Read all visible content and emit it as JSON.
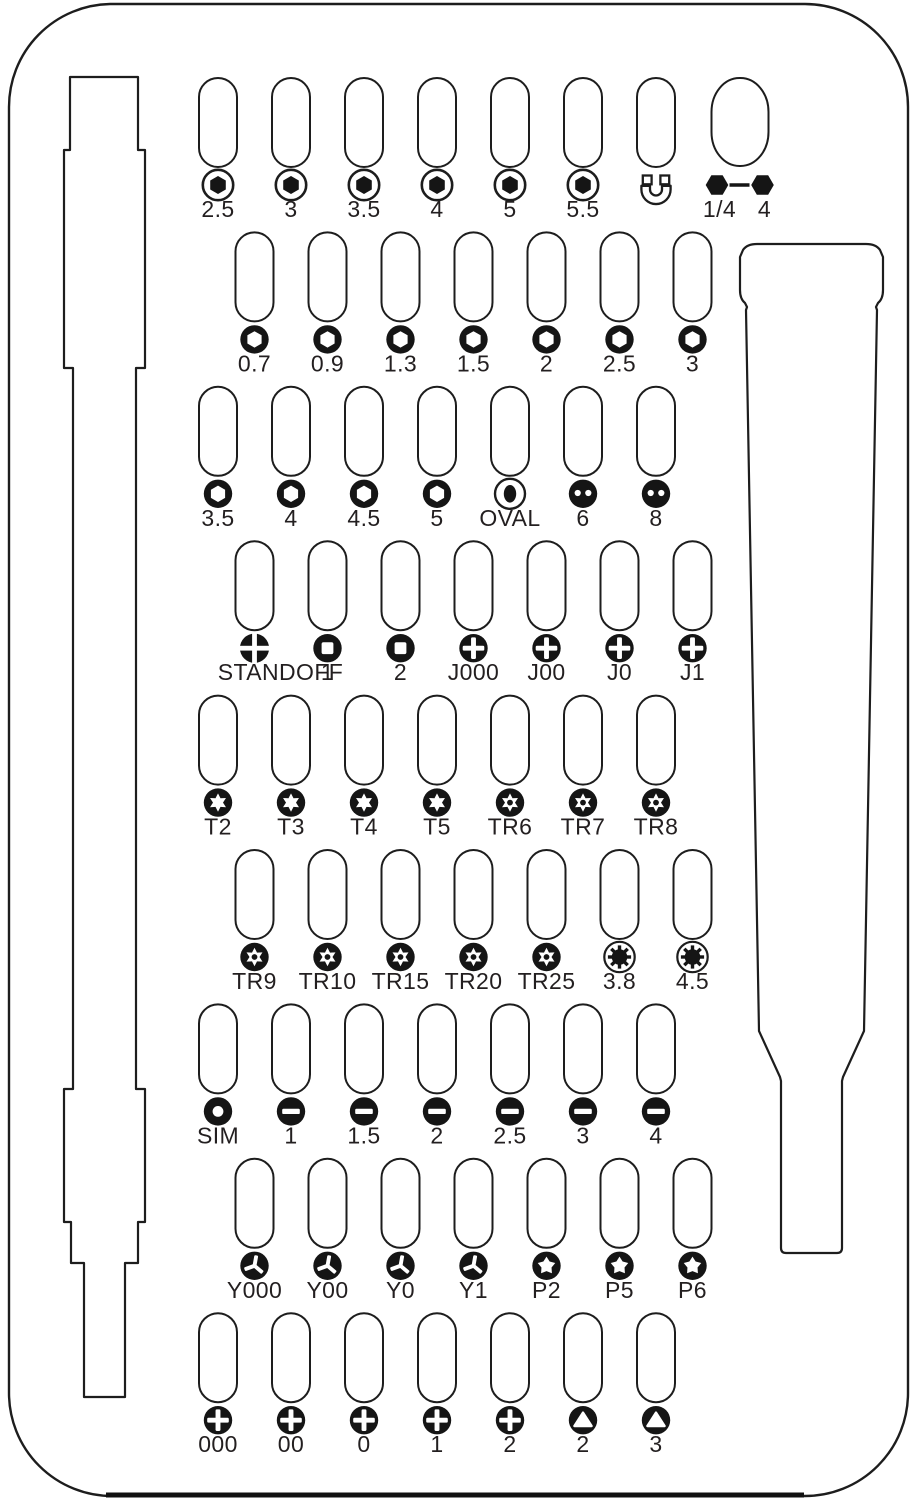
{
  "diagram": {
    "type": "screwdriver-bit-kit-tray",
    "colors": {
      "outline": "#1d1d1d",
      "bit": "#151515",
      "label": "#231f20",
      "background": "#ffffff"
    },
    "tools": [
      {
        "name": "extension-shaft-cutout"
      },
      {
        "name": "driver-handle-cutout"
      }
    ],
    "rows": [
      {
        "bits": [
          {
            "icon": "hex-socket",
            "label": "2.5"
          },
          {
            "icon": "hex-socket",
            "label": "3"
          },
          {
            "icon": "hex-socket",
            "label": "3.5"
          },
          {
            "icon": "hex-socket",
            "label": "4"
          },
          {
            "icon": "hex-socket",
            "label": "5"
          },
          {
            "icon": "hex-socket",
            "label": "5.5"
          },
          {
            "icon": "magnet",
            "label": ""
          },
          {
            "icon": "adapter",
            "label": "1/4",
            "label2": "4",
            "wide": true
          }
        ]
      },
      {
        "bits": [
          {
            "icon": "hex",
            "label": "0.7"
          },
          {
            "icon": "hex",
            "label": "0.9"
          },
          {
            "icon": "hex",
            "label": "1.3"
          },
          {
            "icon": "hex",
            "label": "1.5"
          },
          {
            "icon": "hex",
            "label": "2"
          },
          {
            "icon": "hex",
            "label": "2.5"
          },
          {
            "icon": "hex",
            "label": "3"
          }
        ]
      },
      {
        "bits": [
          {
            "icon": "hex",
            "label": "3.5"
          },
          {
            "icon": "hex",
            "label": "4"
          },
          {
            "icon": "hex",
            "label": "4.5"
          },
          {
            "icon": "hex",
            "label": "5"
          },
          {
            "icon": "oval",
            "label": "OVAL"
          },
          {
            "icon": "spanner",
            "label": "6"
          },
          {
            "icon": "spanner",
            "label": "8"
          }
        ]
      },
      {
        "bits": [
          {
            "icon": "standoff",
            "label": "STANDOFF"
          },
          {
            "icon": "square",
            "label": "1"
          },
          {
            "icon": "square",
            "label": "2"
          },
          {
            "icon": "phillips",
            "label": "J000"
          },
          {
            "icon": "phillips",
            "label": "J00"
          },
          {
            "icon": "phillips",
            "label": "J0"
          },
          {
            "icon": "phillips",
            "label": "J1"
          }
        ]
      },
      {
        "bits": [
          {
            "icon": "torx",
            "label": "T2"
          },
          {
            "icon": "torx",
            "label": "T3"
          },
          {
            "icon": "torx",
            "label": "T4"
          },
          {
            "icon": "torx",
            "label": "T5"
          },
          {
            "icon": "torx-security",
            "label": "TR6"
          },
          {
            "icon": "torx-security",
            "label": "TR7"
          },
          {
            "icon": "torx-security",
            "label": "TR8"
          }
        ]
      },
      {
        "bits": [
          {
            "icon": "torx-security",
            "label": "TR9"
          },
          {
            "icon": "torx-security",
            "label": "TR10"
          },
          {
            "icon": "torx-security",
            "label": "TR15"
          },
          {
            "icon": "torx-security",
            "label": "TR20"
          },
          {
            "icon": "torx-security",
            "label": "TR25"
          },
          {
            "icon": "gamebit",
            "label": "3.8"
          },
          {
            "icon": "gamebit",
            "label": "4.5"
          }
        ]
      },
      {
        "bits": [
          {
            "icon": "sim",
            "label": "SIM"
          },
          {
            "icon": "flathead",
            "label": "1"
          },
          {
            "icon": "flathead",
            "label": "1.5"
          },
          {
            "icon": "flathead",
            "label": "2"
          },
          {
            "icon": "flathead",
            "label": "2.5"
          },
          {
            "icon": "flathead",
            "label": "3"
          },
          {
            "icon": "flathead",
            "label": "4"
          }
        ]
      },
      {
        "bits": [
          {
            "icon": "tri-point-y",
            "label": "Y000"
          },
          {
            "icon": "tri-point-y",
            "label": "Y00"
          },
          {
            "icon": "tri-point-y",
            "label": "Y0"
          },
          {
            "icon": "tri-point-y",
            "label": "Y1"
          },
          {
            "icon": "pentalobe",
            "label": "P2"
          },
          {
            "icon": "pentalobe",
            "label": "P5"
          },
          {
            "icon": "pentalobe",
            "label": "P6"
          }
        ]
      },
      {
        "bits": [
          {
            "icon": "phillips",
            "label": "000"
          },
          {
            "icon": "phillips",
            "label": "00"
          },
          {
            "icon": "phillips",
            "label": "0"
          },
          {
            "icon": "phillips",
            "label": "1"
          },
          {
            "icon": "phillips",
            "label": "2"
          },
          {
            "icon": "triangle",
            "label": "2"
          },
          {
            "icon": "triangle",
            "label": "3"
          }
        ]
      }
    ]
  }
}
